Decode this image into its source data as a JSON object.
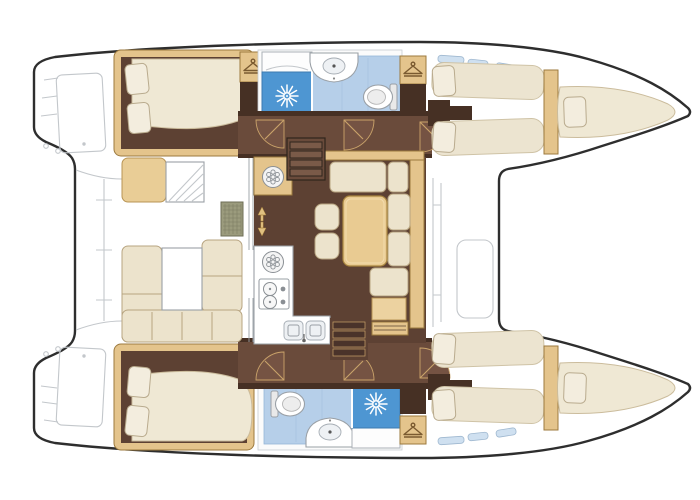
{
  "diagram": {
    "type": "floor-plan",
    "subject": "catamaran-interior-deck-plan",
    "orientation": "bows-to-right"
  },
  "colors": {
    "hull_outline": "#2e2e2e",
    "deck_faint": "#c3c7cb",
    "floor_brown": "#5d4133",
    "corridor_brown": "#6a4b3b",
    "wall_dark": "#463024",
    "wood_tan": "#e4c48c",
    "wood_tan_dark": "#9c7a3e",
    "wood_tan_light": "#ecd2a0",
    "seat_tan": "#e9cd96",
    "seat_tan_border": "#b89454",
    "cushion_cream": "#ece3cc",
    "cushion_border": "#b7a480",
    "bed_cream": "#efe8d4",
    "bed_border": "#cbbc9c",
    "pillow_cream": "#f3edde",
    "pillow_border": "#b9ab8e",
    "berth_cream": "#ece4d0",
    "berth_border": "#cfc3a6",
    "shower_blue": "#4e96d2",
    "shower_blue_dark": "#3d7ab0",
    "bath_floor_blue": "#b6cfe9",
    "bath_floor_border": "#96b6d8",
    "window_blue": "#cfe0f0",
    "window_border": "#9fb8d0",
    "counter_white": "#fdfdfd",
    "counter_border": "#aab0b6",
    "fixture_gray": "#9aa0a6",
    "fixture_fill": "#eef1f4",
    "grid_khaki": "#9b9b7d",
    "grid_border": "#6f6f57",
    "grid_line": "#7d7d63",
    "table_wood": "#e9cb92",
    "table_border": "#a8853f",
    "door_wedge": "#755343",
    "door_leaf": "#caa36a",
    "step_dark": "#4a332a",
    "step_light": "#7a5a48",
    "step_edge": "#2f241c",
    "hanger_brown": "#7a5a30"
  },
  "icons": [
    {
      "name": "shower-head-icon",
      "glyph": "white sunburst rays"
    },
    {
      "name": "clothes-hanger-icon",
      "glyph": "hanger on tan locker"
    },
    {
      "name": "vent-fan-icon",
      "glyph": "circle with dot cluster"
    },
    {
      "name": "stove-icon",
      "glyph": "two burners with knobs"
    },
    {
      "name": "double-sink-icon",
      "glyph": "two square basins with faucet"
    },
    {
      "name": "toilet-icon",
      "glyph": "bowl with tank"
    },
    {
      "name": "washbasin-icon",
      "glyph": "oval basin on white counter"
    }
  ],
  "areas": {
    "hulls": [
      "port-hull",
      "starboard-hull"
    ],
    "port_hull_rooms": [
      "aft-double-cabin",
      "wardrobe",
      "shower",
      "bathroom",
      "corridor",
      "forward-twin-cabin",
      "bow-berth"
    ],
    "starboard_hull_rooms": [
      "aft-double-cabin",
      "bathroom",
      "shower",
      "wardrobe",
      "corridor",
      "forward-twin-cabin",
      "bow-berth"
    ],
    "bridgedeck": [
      "salon-dinette",
      "galley",
      "port-companionway-steps",
      "starboard-companionway-steps"
    ],
    "aft": [
      "cockpit-settee",
      "cockpit-table",
      "helm-seat",
      "transom-steps"
    ],
    "fore": [
      "foredeck",
      "deck-hatch"
    ]
  }
}
